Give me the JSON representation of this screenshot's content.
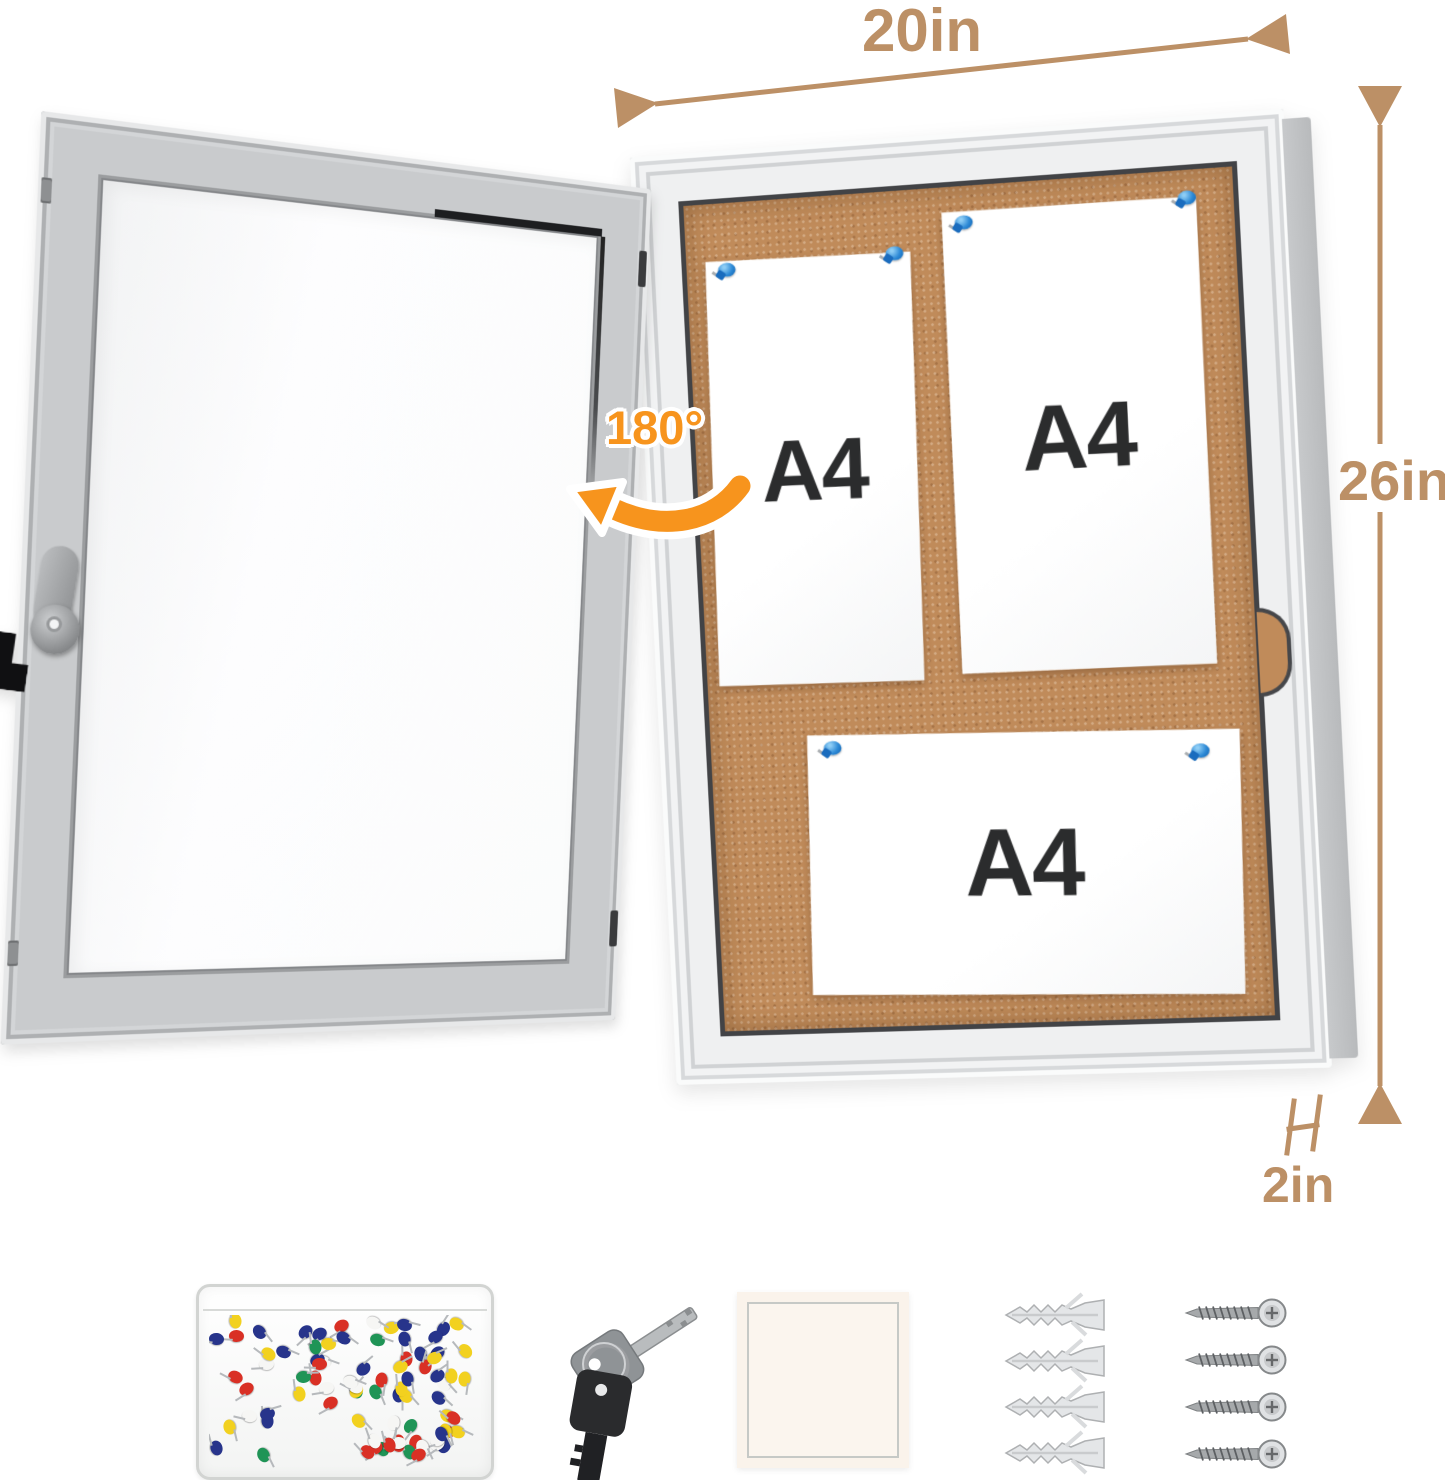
{
  "dimensions": {
    "width_label": "20in",
    "height_label": "26in",
    "depth_label": "2in",
    "door_swing_label": "180°",
    "line_color": "#BC9066",
    "swing_color": "#F7941D"
  },
  "board": {
    "papers": [
      {
        "label": "A4"
      },
      {
        "label": "A4"
      },
      {
        "label": "A4"
      }
    ],
    "pin_color": "#1E78C8",
    "cork_color": "#C08B5A",
    "frame_color": "#EFF0F1"
  },
  "accessories": {
    "pushpin_box": {
      "pin_palette": [
        "#D93025",
        "#27348B",
        "#1F9456",
        "#F2D11F",
        "#F6F6F4"
      ],
      "pin_count": 84
    },
    "keys": {
      "count": 2
    },
    "adhesive_pad": {
      "color": "#FAF3EB"
    },
    "wall_anchors": {
      "count": 4
    },
    "screws": {
      "count": 4
    }
  }
}
